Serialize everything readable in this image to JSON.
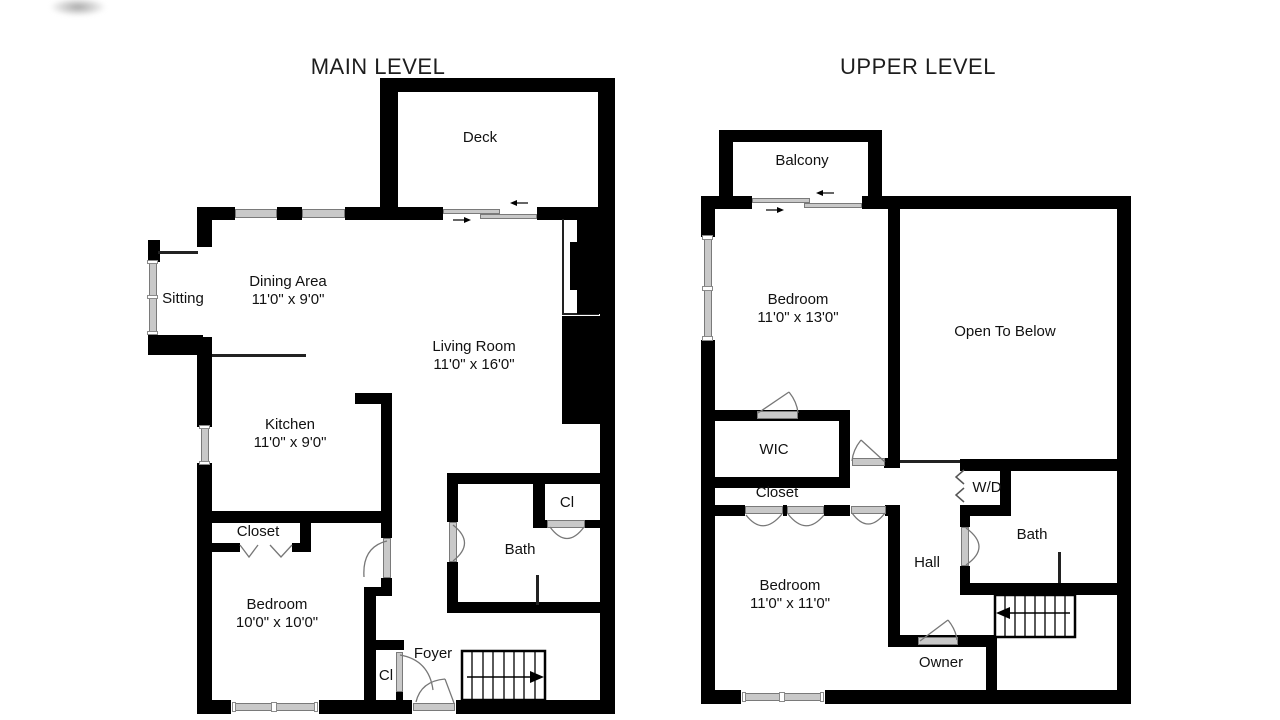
{
  "titles": {
    "main": "MAIN LEVEL",
    "upper": "UPPER LEVEL"
  },
  "main_level": {
    "deck": {
      "name": "Deck"
    },
    "sitting": {
      "name": "Sitting"
    },
    "dining": {
      "name": "Dining Area",
      "dims": "11'0\" x 9'0\""
    },
    "living": {
      "name": "Living Room",
      "dims": "11'0\" x 16'0\""
    },
    "kitchen": {
      "name": "Kitchen",
      "dims": "11'0\" x 9'0\""
    },
    "closet": {
      "name": "Closet"
    },
    "bedroom": {
      "name": "Bedroom",
      "dims": "10'0\" x 10'0\""
    },
    "foyer": {
      "name": "Foyer"
    },
    "foyer_closet": {
      "name": "Cl"
    },
    "bath": {
      "name": "Bath"
    },
    "bath_closet": {
      "name": "Cl"
    }
  },
  "upper_level": {
    "balcony": {
      "name": "Balcony"
    },
    "bedroom_front": {
      "name": "Bedroom",
      "dims": "11'0\" x 13'0\""
    },
    "open_to_below": {
      "name": "Open To Below"
    },
    "wic": {
      "name": "WIC"
    },
    "closet": {
      "name": "Closet"
    },
    "bedroom_rear": {
      "name": "Bedroom",
      "dims": "11'0\" x 11'0\""
    },
    "hall": {
      "name": "Hall"
    },
    "wd": {
      "name": "W/D"
    },
    "bath": {
      "name": "Bath"
    },
    "owner": {
      "name": "Owner"
    }
  },
  "colors": {
    "wall": "#000000",
    "window": "#c9c9c9",
    "door_arc": "#777777",
    "text": "#111111"
  }
}
